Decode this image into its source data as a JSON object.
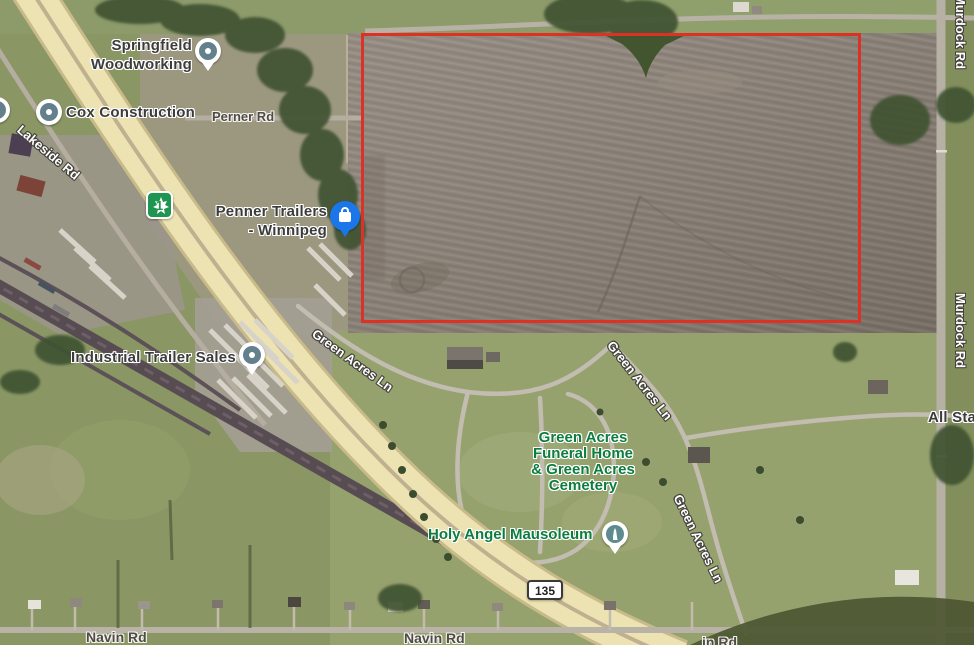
{
  "map": {
    "description": "Satellite aerial map with red-outlined land parcel near Trans-Canada Highway 1 and Green Acres Cemetery",
    "poi_labels": {
      "springfield": {
        "line1": "Springfield",
        "line2": "Woodworking"
      },
      "cox": "Cox Construction",
      "penner": {
        "line1": "Penner Trailers",
        "line2": "- Winnipeg"
      },
      "industrial": "Industrial Trailer Sales",
      "green_acres": {
        "line1": "Green Acres",
        "line2": "Funeral Home",
        "line3": "& Green Acres",
        "line4": "Cemetery"
      },
      "holy_angel": "Holy Angel Mausoleum",
      "all_star_partial": "All Sta"
    },
    "road_labels": {
      "perner": "Perner Rd",
      "lakeside": "Lakeside Rd",
      "green_acres_ln": "Green Acres Ln",
      "navin": "Navin Rd",
      "navin_partial": "in Rd",
      "murdock": "Murdock Rd"
    },
    "route_shields": {
      "trans_canada": "1",
      "provincial": "135"
    },
    "icons": {
      "springfield_pin": "teardrop-place-pin",
      "cox_pin": "circle-place-pin",
      "edge_pin": "circle-place-pin",
      "industrial_pin": "teardrop-place-pin",
      "penner_pin": "blue-shopping-bag-pin",
      "holy_angel_pin": "teardrop-monument-pin",
      "trans_canada_shield": "green-maple-leaf-shield",
      "provincial_shield": "white-rounded-route-shield"
    },
    "colors": {
      "parcel_outline": "#dd3126",
      "field_brown": "#8c8177",
      "grass_green": "#8a9765",
      "cemetery_green": "#98a471",
      "highway_yellow": "#ede3b2",
      "rail_dark": "#584c53",
      "road_gray": "#b7b1a6",
      "tree_green": "#3f5233",
      "area_label_green": "#0c7c3f",
      "poi_pin_blue": "#1b76ea",
      "poi_pin_slate": "#64808d",
      "shield_green": "#1e9550"
    }
  }
}
